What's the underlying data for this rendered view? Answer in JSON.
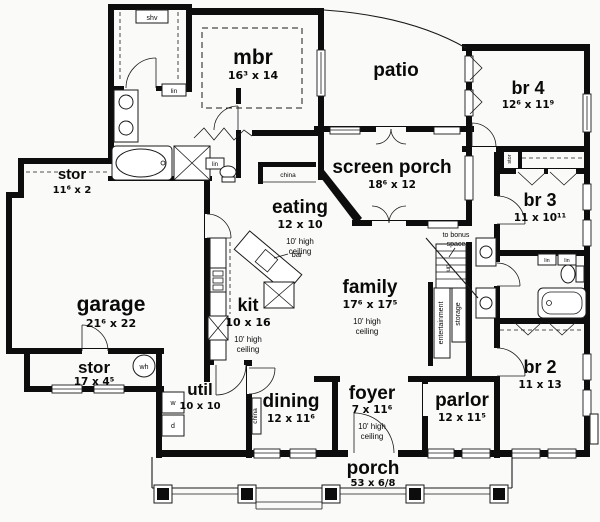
{
  "colors": {
    "ink": "#0d0d0d",
    "paper": "#fafaf8"
  },
  "rooms": {
    "shv": {
      "label": "shv"
    },
    "stor_upper": {
      "label": "stor",
      "dims": "11⁶ x 2"
    },
    "mbr": {
      "label": "mbr",
      "dims": "16³ x 14"
    },
    "patio": {
      "label": "patio"
    },
    "br4": {
      "label": "br 4",
      "dims": "12⁶ x 11⁹"
    },
    "screen_porch": {
      "label": "screen porch",
      "dims": "18⁶ x 12"
    },
    "eating": {
      "label": "eating",
      "dims": "12 x 10",
      "note1": "10' high",
      "note2": "ceiling"
    },
    "br3": {
      "label": "br 3",
      "dims": "11 x 10¹¹"
    },
    "garage": {
      "label": "garage",
      "dims": "21⁶ x 22"
    },
    "kit": {
      "label": "kit",
      "dims": "10 x 16",
      "note1": "10' high",
      "note2": "ceiling"
    },
    "family": {
      "label": "family",
      "dims": "17⁶ x 17⁵",
      "note1": "10' high",
      "note2": "ceiling"
    },
    "br2": {
      "label": "br 2",
      "dims": "11 x 13"
    },
    "stor_lower": {
      "label": "stor",
      "dims": "17 x 4⁵"
    },
    "util": {
      "label": "util",
      "dims": "10 x 10"
    },
    "dining": {
      "label": "dining",
      "dims": "12 x 11⁶"
    },
    "foyer": {
      "label": "foyer",
      "dims": "7 x 11⁶",
      "note1": "10' high",
      "note2": "ceiling"
    },
    "parlor": {
      "label": "parlor",
      "dims": "12 x 11⁵"
    },
    "porch": {
      "label": "porch",
      "dims": "53 x 6/8"
    }
  },
  "annotations": {
    "china": "china",
    "bar": "bar",
    "to_bonus_1": "to bonus",
    "to_bonus_2": "space",
    "up": "up",
    "entertainment": "entertainment",
    "storage": "storage",
    "stor_closet": "stor",
    "lin": "lin",
    "washer": "w",
    "dryer": "d",
    "water_heater": "wh"
  }
}
